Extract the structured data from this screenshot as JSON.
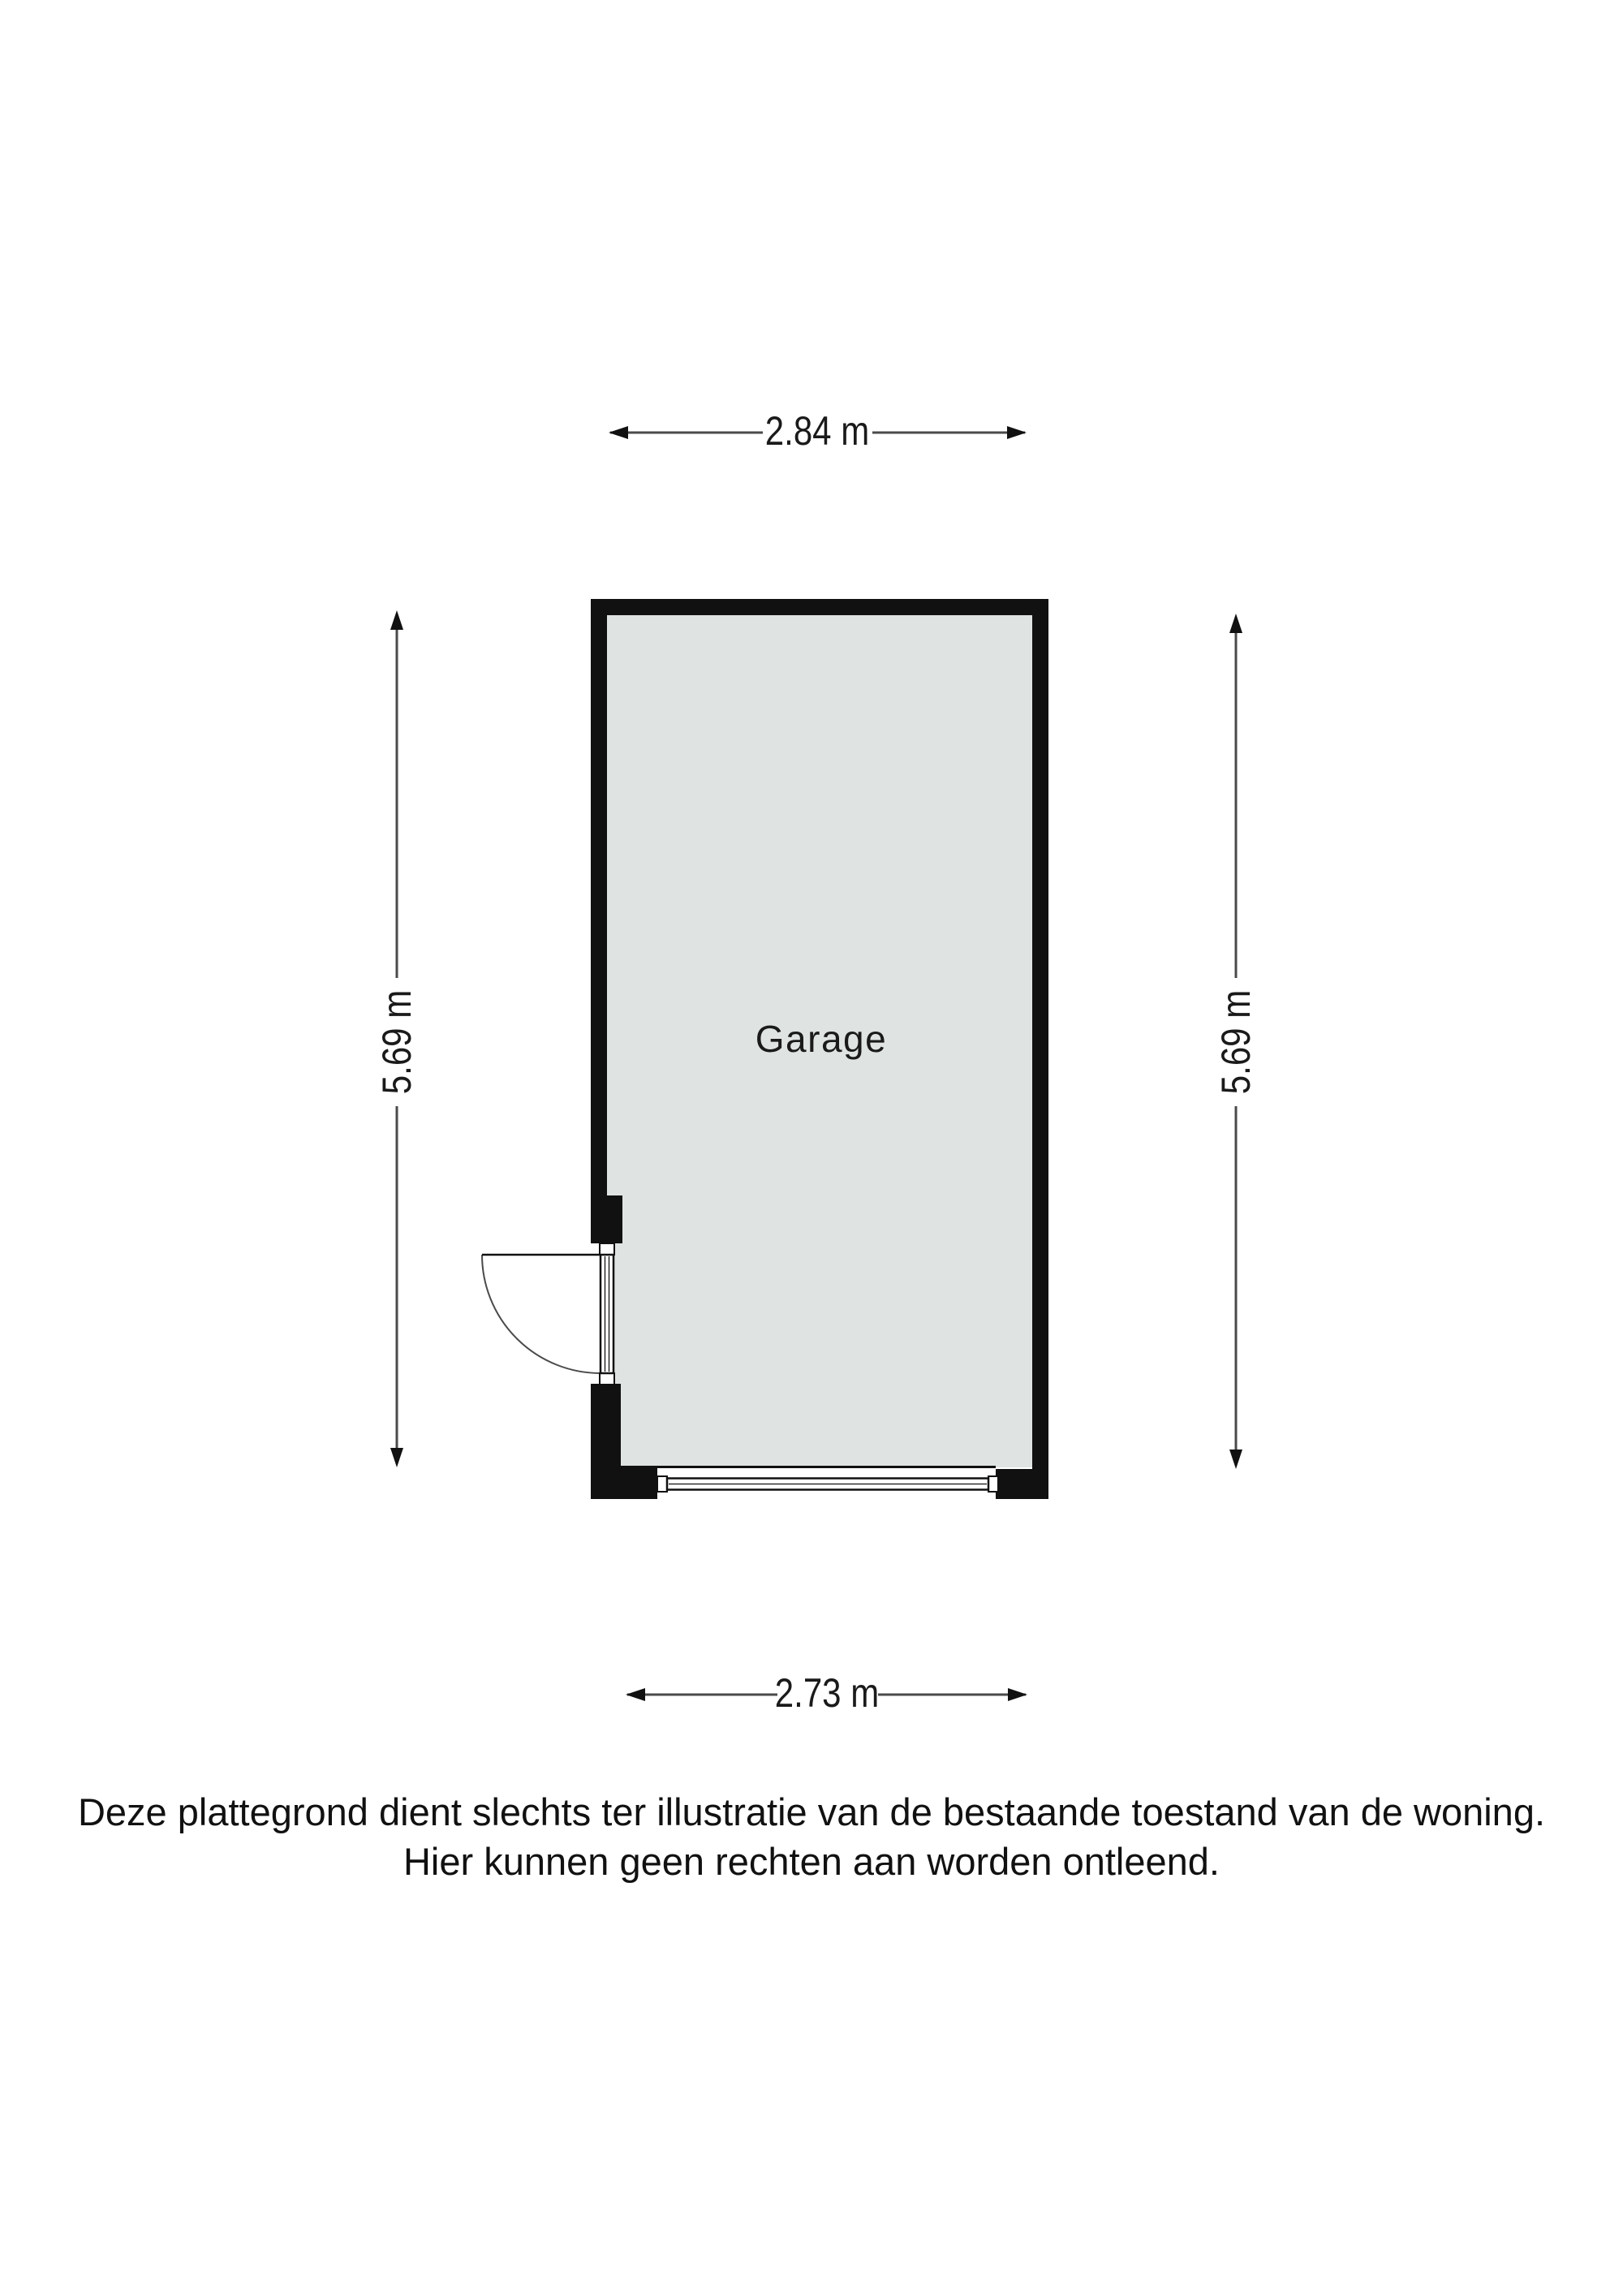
{
  "floorplan": {
    "room": {
      "label": "Garage"
    },
    "dimensions": {
      "width_top": "2.84 m",
      "width_bottom": "2.73 m",
      "height_left": "5.69 m",
      "height_right": "5.69 m"
    },
    "disclaimer_line1": "Deze plattegrond dient slechts ter illustratie van de bestaande toestand van de woning.",
    "disclaimer_line2": "Hier kunnen geen rechten aan worden ontleend.",
    "colors": {
      "wall": "#111111",
      "floor_fill": "#dfe3e2",
      "dimension_line": "#4a4a4a",
      "arrowhead": "#111111",
      "text": "#1a1a1a",
      "background": "#ffffff"
    }
  }
}
